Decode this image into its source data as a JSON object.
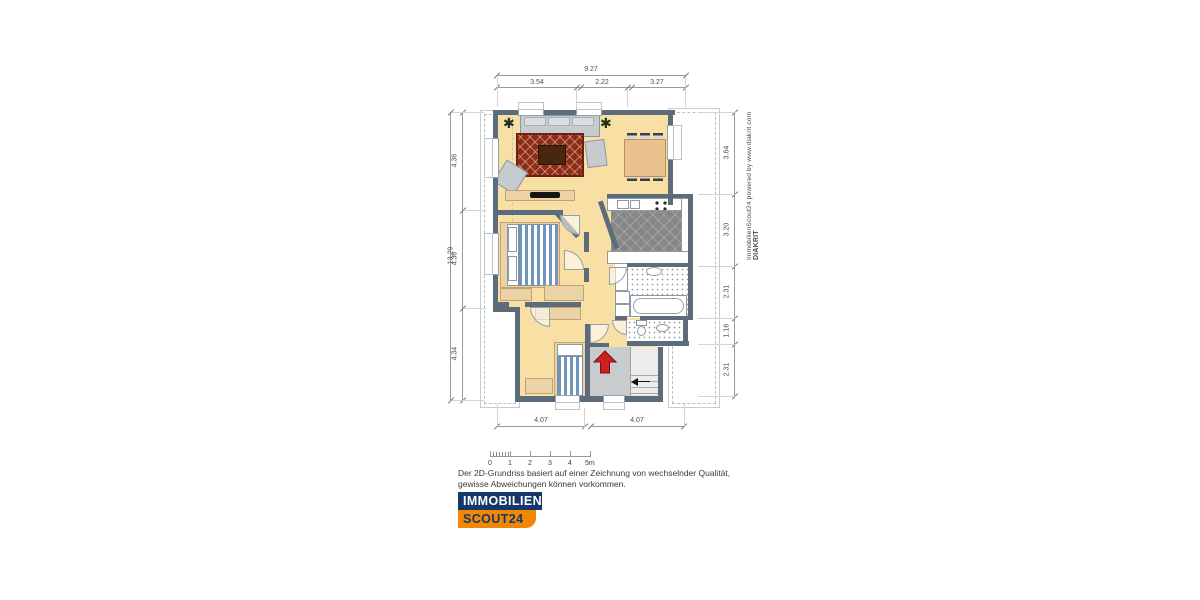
{
  "plan": {
    "dims": {
      "top_total": "9.27",
      "top_segments": [
        "3.54",
        "2.22",
        "3.27"
      ],
      "left_total": "13.29",
      "left_segments": [
        "4.36",
        "4.36",
        "4.34"
      ],
      "right_segments": [
        "3.64",
        "3.20",
        "2.31",
        "1.16",
        "2.31"
      ],
      "bottom_segments": [
        "4.07",
        "4.07"
      ]
    },
    "scale_labels": [
      "0",
      "1",
      "2",
      "3",
      "4",
      "5m"
    ]
  },
  "watermark": {
    "prefix": "ImmobilienScout24 powered by www.diakrit.com ",
    "brand": "DIAKRIT"
  },
  "disclaimer": {
    "line1": "Der 2D-Grundriss basiert auf einer Zeichnung von wechselnder Qualität,",
    "line2": "gewisse Abweichungen können vorkommen."
  },
  "logo": {
    "line1": "IMMOBILIEN",
    "line2": "SCOUT24"
  },
  "icons": {
    "plant": "✱"
  },
  "colors": {
    "wall": "#5d6c7b",
    "floor": "#f8dfa4",
    "kitchen_tile": "#878787",
    "stair_floor": "#c9cccf",
    "rug": "#8e2c1b",
    "bed_stripe": "#6f95bd",
    "entrance_arrow": "#cc2020",
    "logo_blue": "#14386a",
    "logo_orange": "#f28705"
  }
}
